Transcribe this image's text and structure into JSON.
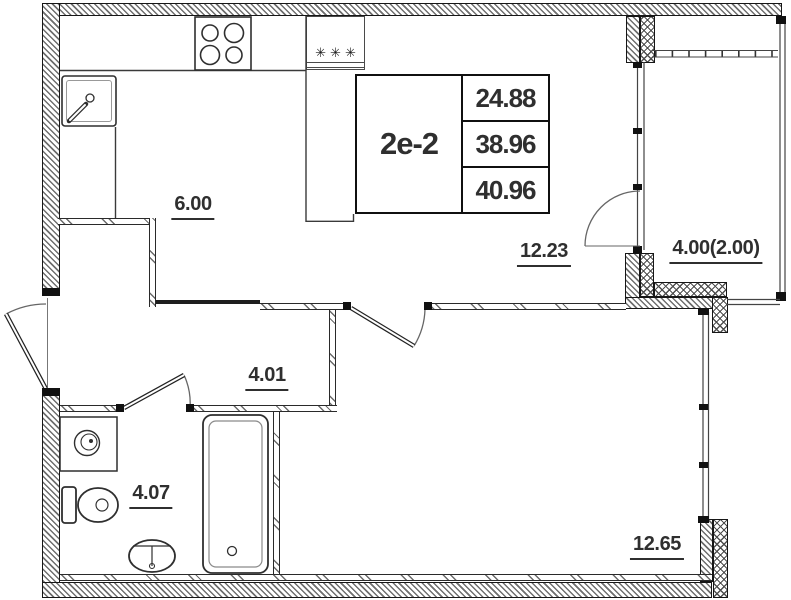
{
  "plan": {
    "unit": {
      "type_label": "2е-2",
      "area_rows": [
        "24.88",
        "38.96",
        "40.96"
      ]
    },
    "rooms": [
      {
        "name": "kitchen-zone",
        "area_label": "6.00"
      },
      {
        "name": "living-zone",
        "area_label": "12.23"
      },
      {
        "name": "balcony",
        "area_label": "4.00(2.00)"
      },
      {
        "name": "hallway",
        "area_label": "4.01"
      },
      {
        "name": "bathroom",
        "area_label": "4.07"
      },
      {
        "name": "bedroom",
        "area_label": "12.65"
      }
    ],
    "symbols": {
      "fridge": "✳✳✳"
    },
    "colors": {
      "line": "#1a1a1a",
      "hatch": "#6f6f6f",
      "label_text": "#2f2f2f",
      "background": "#ffffff"
    }
  }
}
